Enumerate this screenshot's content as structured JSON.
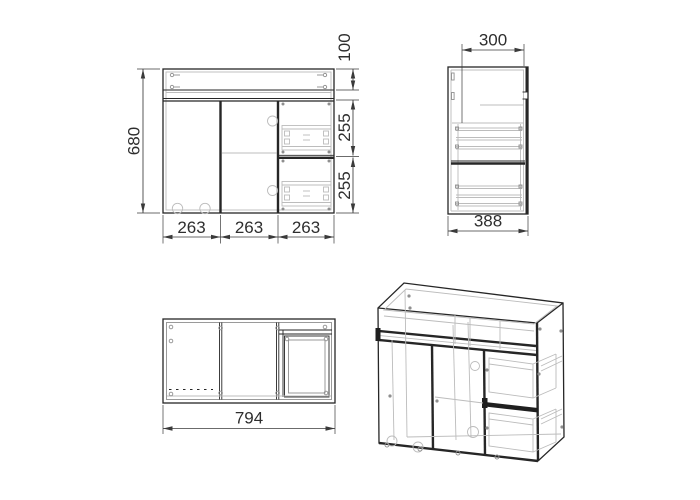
{
  "labels": {
    "front_height": "680",
    "front_top_rail": "100",
    "front_drawer_upper": "255",
    "front_drawer_lower": "255",
    "front_bottom_sections": [
      "263",
      "263",
      "263"
    ],
    "side_top_depth": "300",
    "side_depth": "388",
    "top_width": "794"
  },
  "colors": {
    "line": "#262626",
    "light_line": "#bcbcbc",
    "medium_line": "#8f8f8f",
    "dimension": "#3a3a3a",
    "background": "#ffffff",
    "text": "#2e2e2e"
  }
}
